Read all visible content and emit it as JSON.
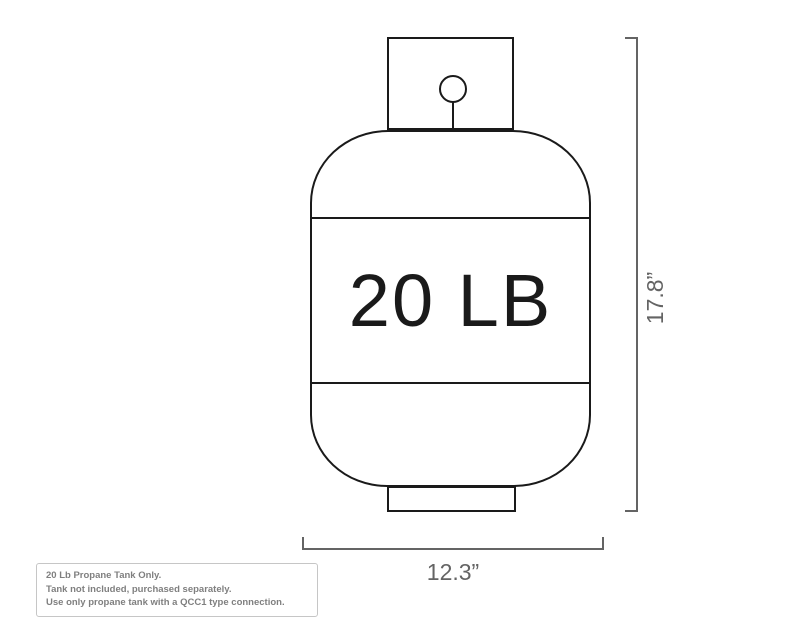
{
  "diagram": {
    "title": "propane tank dimension diagram",
    "tank": {
      "label": "20 LB"
    },
    "dimensions": {
      "height_label": "17.8”",
      "width_label": "12.3”"
    },
    "note": {
      "lines": [
        "20 Lb Propane Tank Only.",
        "Tank not included, purchased separately.",
        "Use only propane tank with a QCC1 type connection."
      ]
    },
    "colors": {
      "outline": "#1a1a1a",
      "dimension_line": "#646464",
      "dimension_text": "#646464",
      "note_text": "#7f7f7f",
      "note_border": "#c6c6c6",
      "background": "#ffffff"
    }
  }
}
